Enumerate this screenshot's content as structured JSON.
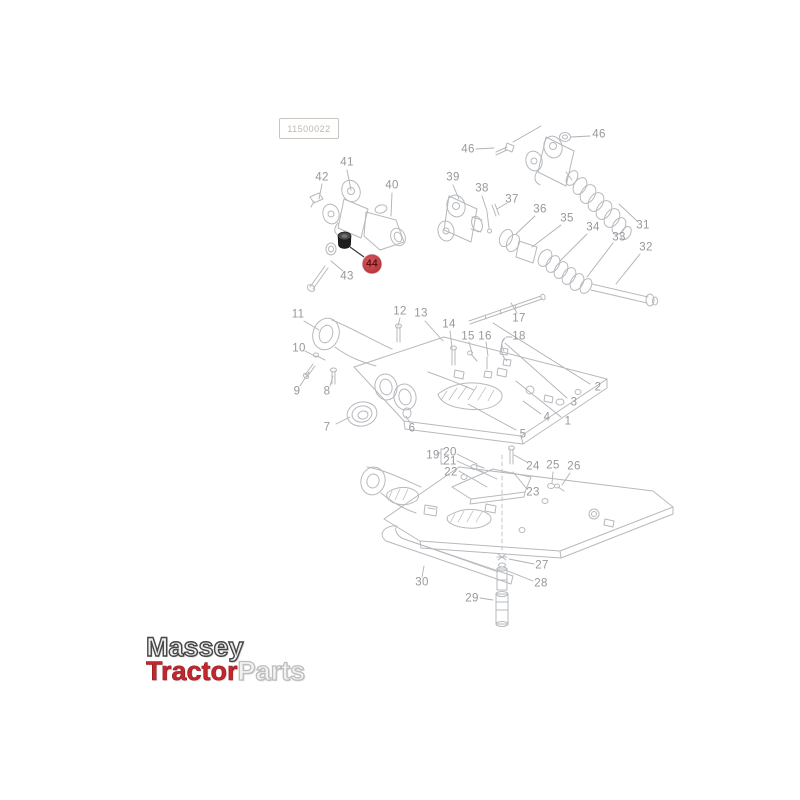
{
  "page": {
    "background": "#ffffff"
  },
  "drawing_number_box": {
    "code": "11500022"
  },
  "diagram": {
    "type": "exploded-parts-diagram",
    "line_color": "#b6b9bd",
    "leader_color": "#aeb1b5",
    "label_color": "#96989c",
    "highlighted_part": {
      "number": "44",
      "circle_color": "#c04046",
      "text_color": "#5c0d12",
      "part_fill": "#1e1e1e"
    },
    "labels": [
      {
        "n": "1",
        "x": 568,
        "y": 422
      },
      {
        "n": "2",
        "x": 598,
        "y": 388
      },
      {
        "n": "3",
        "x": 574,
        "y": 403
      },
      {
        "n": "4",
        "x": 547,
        "y": 418
      },
      {
        "n": "5",
        "x": 523,
        "y": 435
      },
      {
        "n": "6",
        "x": 412,
        "y": 429
      },
      {
        "n": "7",
        "x": 327,
        "y": 428
      },
      {
        "n": "8",
        "x": 327,
        "y": 392
      },
      {
        "n": "9",
        "x": 297,
        "y": 392
      },
      {
        "n": "10",
        "x": 299,
        "y": 349
      },
      {
        "n": "11",
        "x": 298,
        "y": 315
      },
      {
        "n": "12",
        "x": 400,
        "y": 312
      },
      {
        "n": "13",
        "x": 421,
        "y": 314
      },
      {
        "n": "14",
        "x": 449,
        "y": 325
      },
      {
        "n": "15",
        "x": 468,
        "y": 337
      },
      {
        "n": "16",
        "x": 485,
        "y": 337
      },
      {
        "n": "17",
        "x": 519,
        "y": 319
      },
      {
        "n": "18",
        "x": 519,
        "y": 337
      },
      {
        "n": "19",
        "x": 433,
        "y": 456
      },
      {
        "n": "20",
        "x": 450,
        "y": 453
      },
      {
        "n": "21",
        "x": 450,
        "y": 462
      },
      {
        "n": "22",
        "x": 451,
        "y": 473
      },
      {
        "n": "23",
        "x": 533,
        "y": 493
      },
      {
        "n": "24",
        "x": 533,
        "y": 467
      },
      {
        "n": "25",
        "x": 553,
        "y": 466
      },
      {
        "n": "26",
        "x": 574,
        "y": 467
      },
      {
        "n": "27",
        "x": 542,
        "y": 566
      },
      {
        "n": "28",
        "x": 541,
        "y": 584
      },
      {
        "n": "29",
        "x": 472,
        "y": 599
      },
      {
        "n": "30",
        "x": 422,
        "y": 583
      },
      {
        "n": "31",
        "x": 643,
        "y": 226
      },
      {
        "n": "32",
        "x": 646,
        "y": 248
      },
      {
        "n": "33",
        "x": 619,
        "y": 238
      },
      {
        "n": "34",
        "x": 593,
        "y": 228
      },
      {
        "n": "35",
        "x": 567,
        "y": 219
      },
      {
        "n": "36",
        "x": 540,
        "y": 210
      },
      {
        "n": "37",
        "x": 512,
        "y": 200
      },
      {
        "n": "38",
        "x": 482,
        "y": 189
      },
      {
        "n": "39",
        "x": 453,
        "y": 178
      },
      {
        "n": "40",
        "x": 392,
        "y": 186
      },
      {
        "n": "41",
        "x": 347,
        "y": 163
      },
      {
        "n": "42",
        "x": 322,
        "y": 178
      },
      {
        "n": "43",
        "x": 347,
        "y": 277
      },
      {
        "n": "44",
        "x": 372,
        "y": 264,
        "highlight": true
      },
      {
        "n": "46",
        "x": 468,
        "y": 150
      },
      {
        "n": "46",
        "x": 599,
        "y": 135
      }
    ]
  },
  "logo": {
    "line1": "Massey",
    "line2_part1": "Tractor",
    "line2_part2": "Parts",
    "colors": {
      "line1": "#454545",
      "line2_part1": "#c1272d",
      "line2_part2": "#f2f2f2"
    }
  }
}
